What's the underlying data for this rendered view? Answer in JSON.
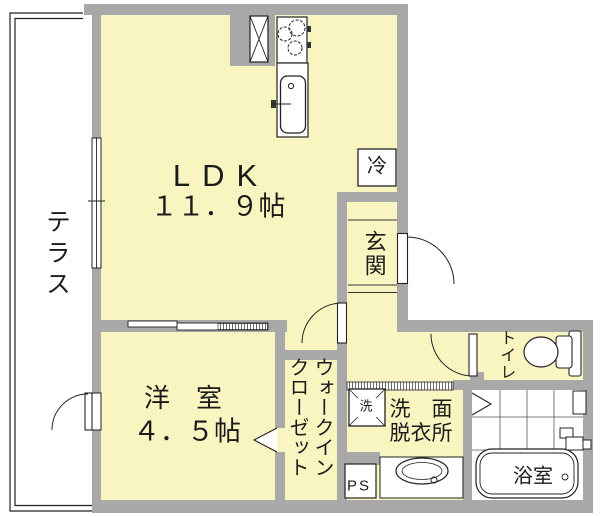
{
  "plan": {
    "type": "japanese-apartment-floor-plan",
    "colors": {
      "room_fill": "#f8f5c1",
      "wall": "#a8a8a8",
      "line": "#1b1b1b",
      "fixture_fill": "#ffffff"
    },
    "rooms": {
      "terrace": {
        "label": "テラス"
      },
      "ldk": {
        "label": "LDK",
        "size": "１１．９帖"
      },
      "entrance": {
        "label": "玄関"
      },
      "western": {
        "label": "洋　室",
        "size": "４．５帖"
      },
      "closet": {
        "label": "ウォークイン\nクローゼット"
      },
      "toilet": {
        "label": "トイレ"
      },
      "washroom": {
        "label": "洗　面\n脱衣所"
      },
      "bathroom": {
        "label": "浴室"
      },
      "pipe_space": {
        "label": "PS"
      }
    },
    "fixtures": {
      "refrigerator": {
        "label": "冷"
      },
      "washer": {
        "label": "洗"
      }
    }
  }
}
